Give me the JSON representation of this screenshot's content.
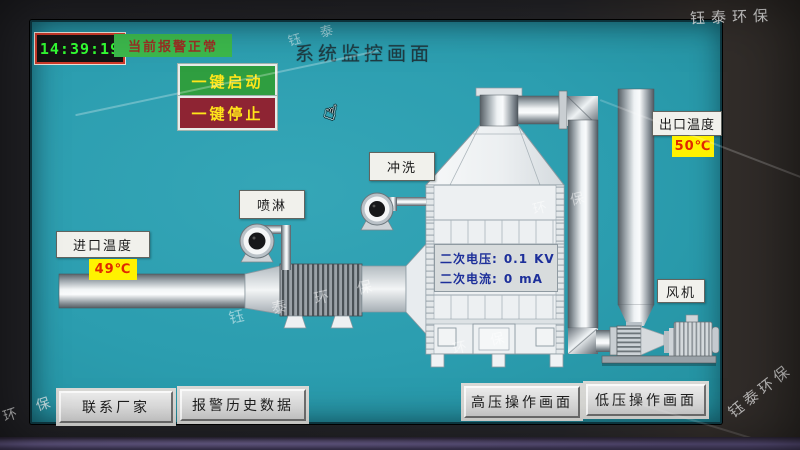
{
  "window": {
    "title": "系统监控画面"
  },
  "header": {
    "clock": "14:39:19",
    "alarm_status": "当前报警正常",
    "buttons": {
      "start": "一键启动",
      "stop": "一键停止"
    }
  },
  "equipment_labels": {
    "spray_pump": "喷淋",
    "flush_pump": "冲洗",
    "fan": "风机",
    "inlet_temperature": {
      "label": "进口温度",
      "value": "49℃"
    },
    "outlet_temperature": {
      "label": "出口温度",
      "value": "50℃"
    }
  },
  "tower_readings": {
    "secondary_voltage": {
      "label": "二次电压:",
      "value": "0.1",
      "unit": "KV"
    },
    "secondary_current": {
      "label": "二次电流:",
      "value": "0",
      "unit": "mA"
    }
  },
  "nav_buttons": [
    {
      "label": "联系厂家"
    },
    {
      "label": "报警历史数据"
    },
    {
      "label": "高压操作画面"
    },
    {
      "label": "低压操作画面"
    }
  ],
  "watermark": {
    "brand": "钰泰环保",
    "spaced_full": "钰 泰 环 保",
    "spaced_front": "钰 泰",
    "spaced_back": "环 保"
  },
  "cursor": {
    "icon": "hand-pointer-icon",
    "glyph": "☝"
  },
  "colors": {
    "screen_bg": "#2B9DAF",
    "alarm_bg": "#3CB84C",
    "start_bg": "#2F9E40",
    "stop_bg": "#8E2433",
    "value_bg": "#FFF200",
    "value_fg": "#E02800",
    "time_fg": "#33FF33",
    "time_border": "#CF3A2A"
  }
}
